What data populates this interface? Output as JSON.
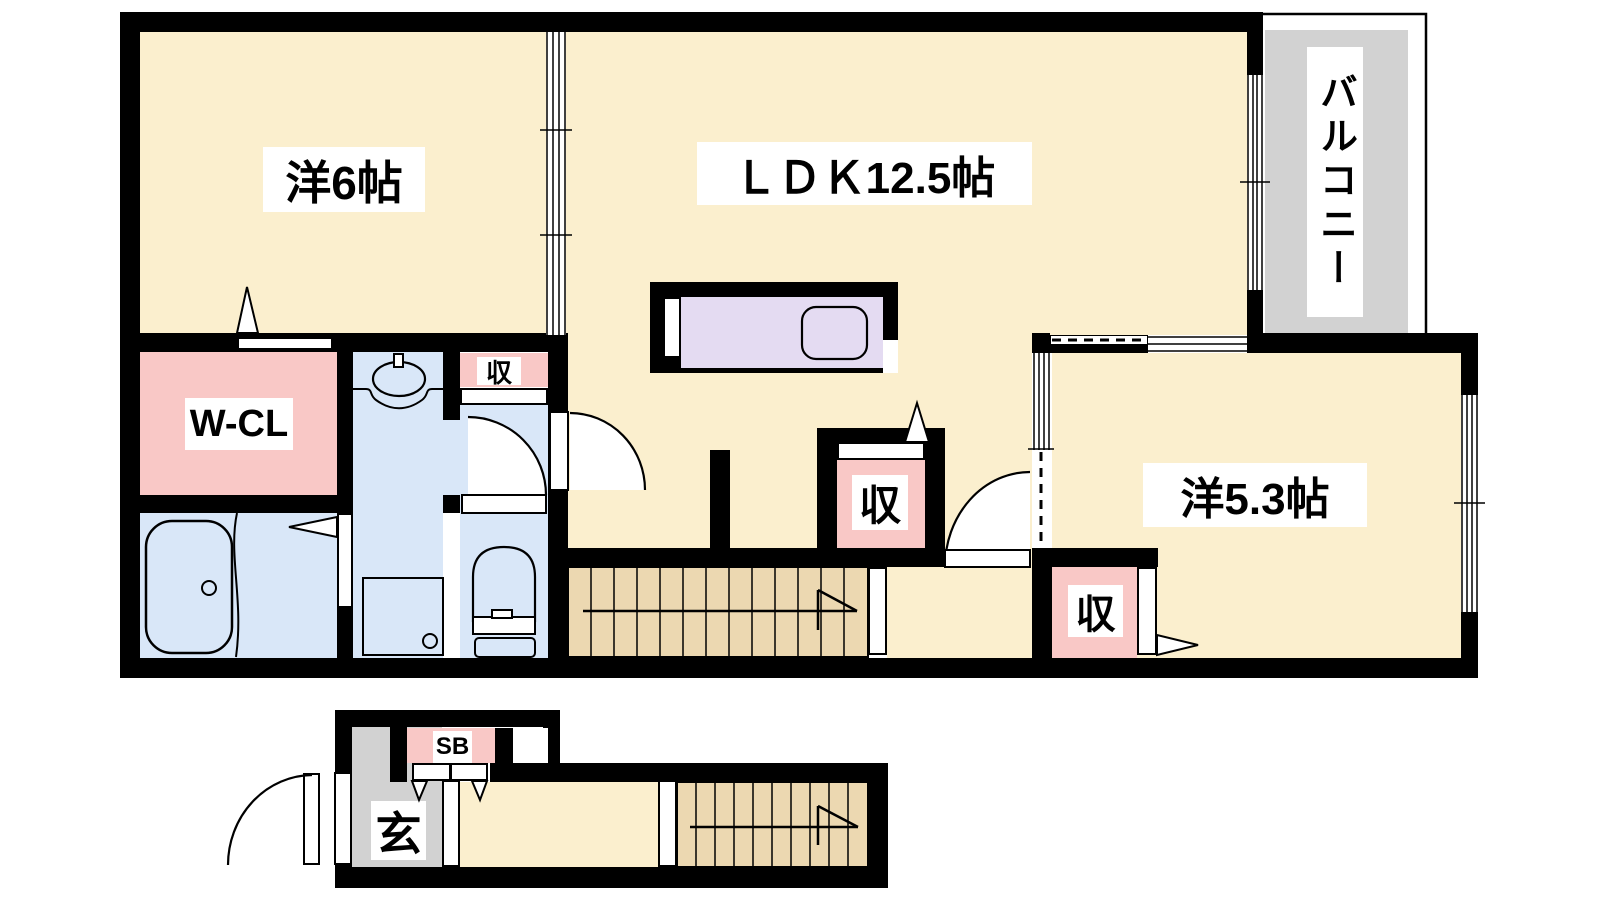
{
  "plan_title": "2-story apartment floor plan",
  "rooms": {
    "western6": "洋6帖",
    "ldk": "ＬＤＫ12.5帖",
    "western53": "洋5.3帖",
    "walkin_closet": "W-CL",
    "balcony": "バルコニー",
    "storage": "収",
    "entrance": "玄",
    "shoe_box": "SB"
  },
  "colors": {
    "room_cream": "#FBEFCE",
    "closet_pink": "#F9C8C6",
    "wet_blue": "#D9E7F8",
    "kitchen_purple": "#E4DBF2",
    "stairs_tan": "#ECD8B1",
    "balcony_gray": "#D2D2D2",
    "wall_black": "#000000"
  }
}
